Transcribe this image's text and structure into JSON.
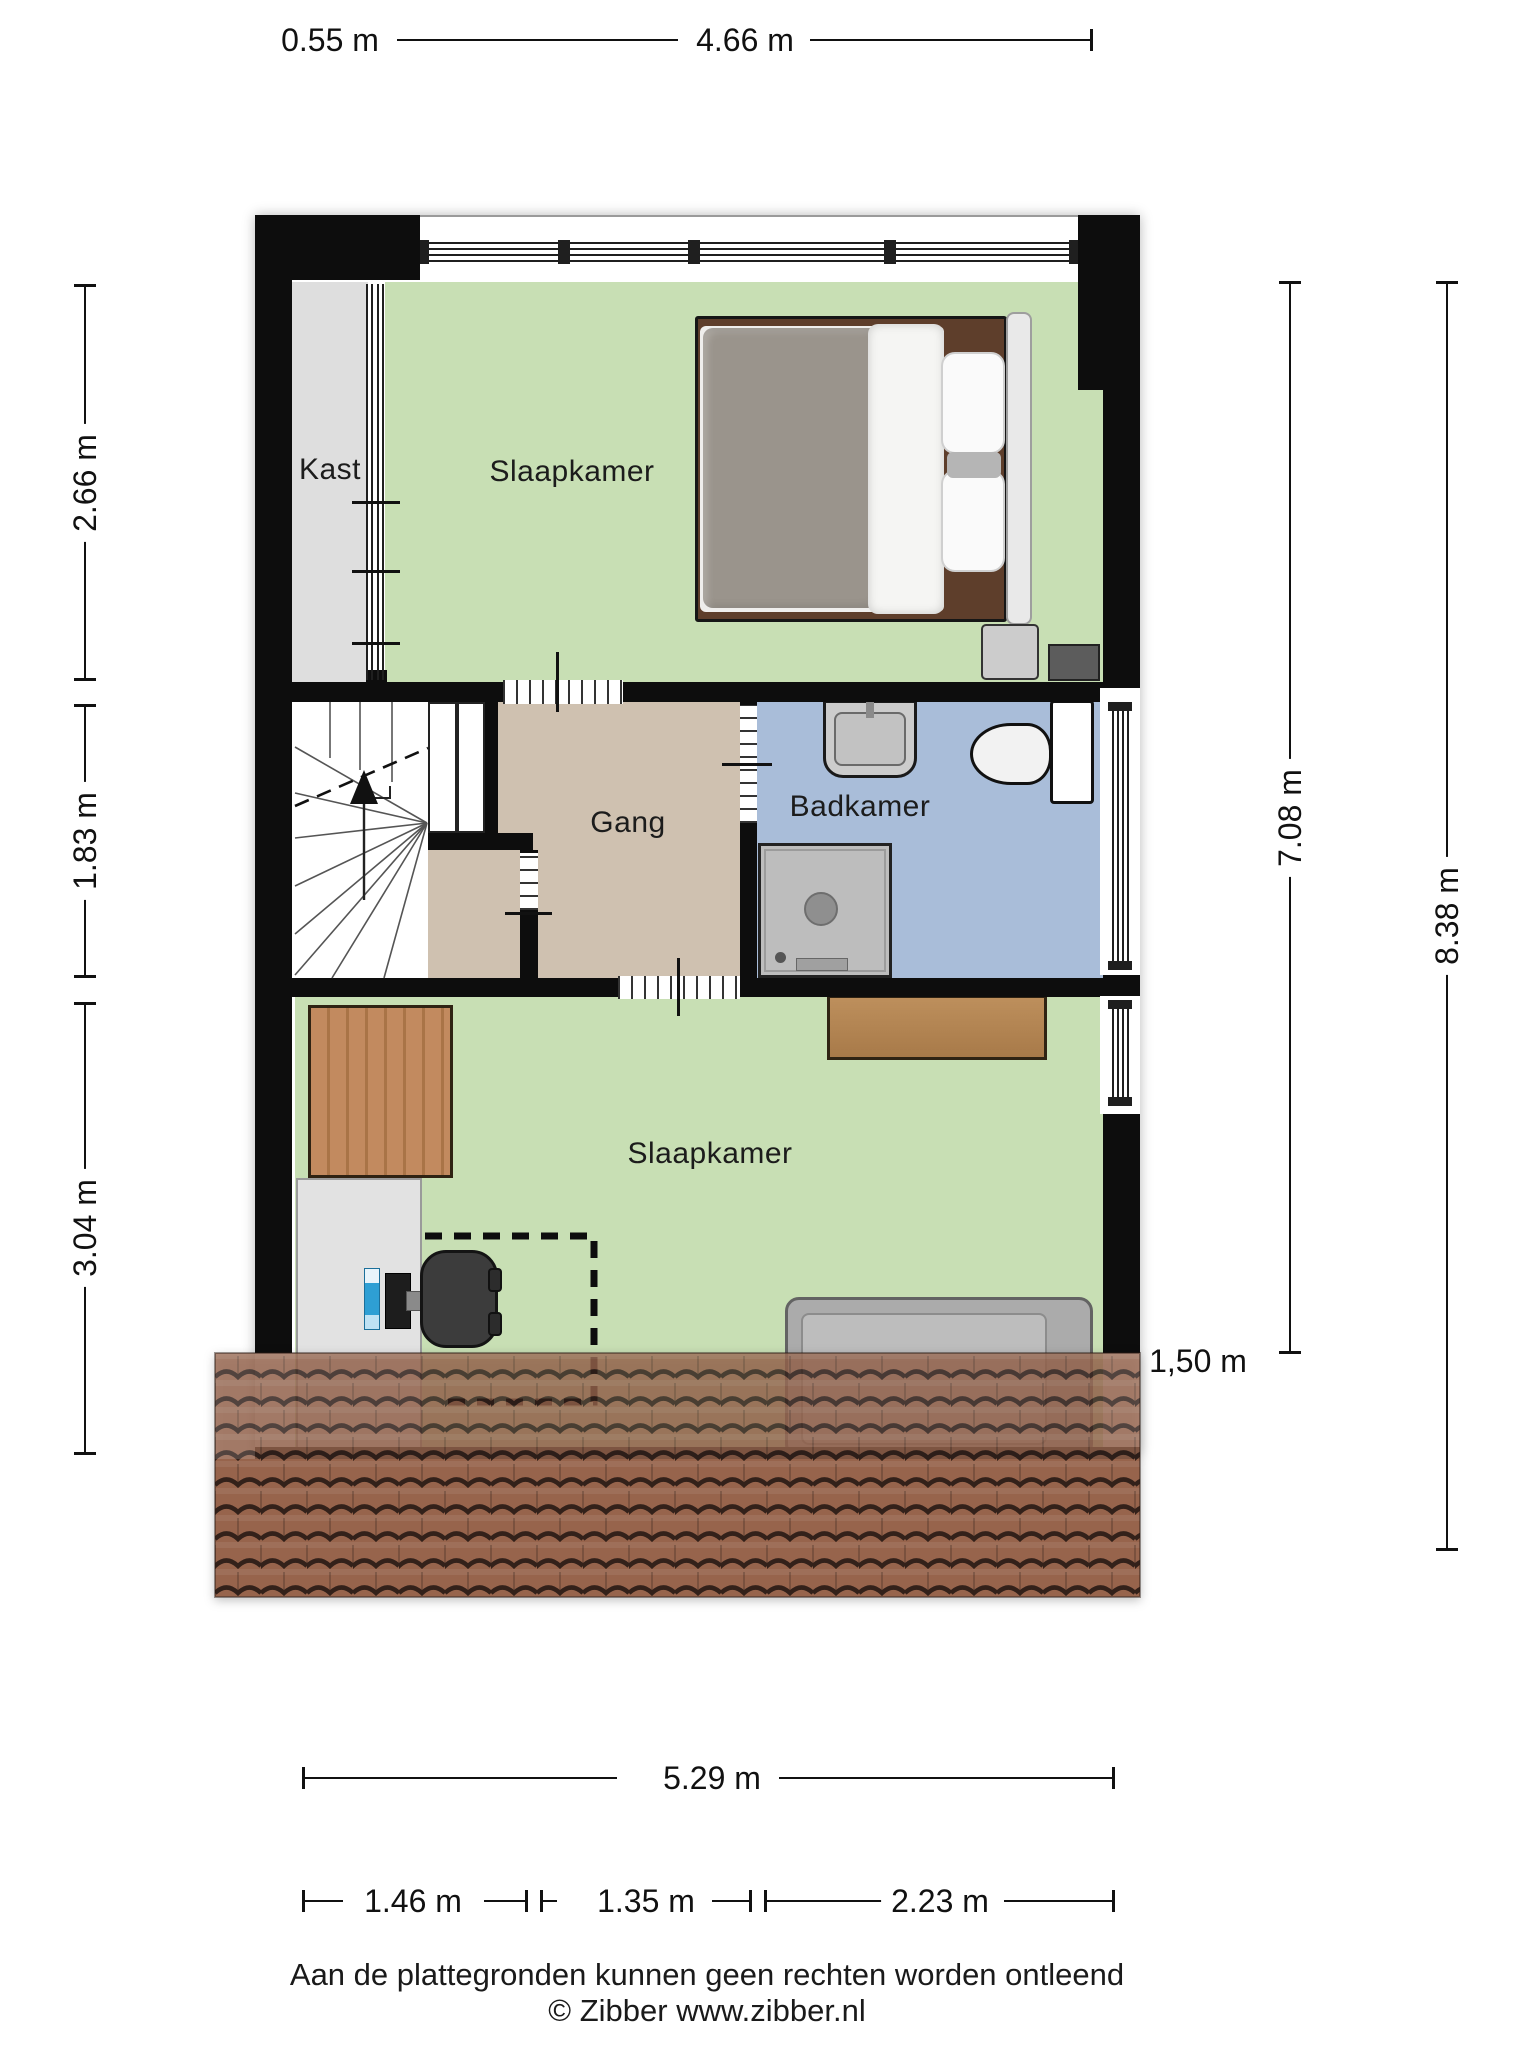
{
  "rooms": {
    "closet": {
      "label": "Kast"
    },
    "bedroom_top": {
      "label": "Slaapkamer"
    },
    "hallway": {
      "label": "Gang"
    },
    "bathroom": {
      "label": "Badkamer"
    },
    "bedroom_bottom": {
      "label": "Slaapkamer"
    }
  },
  "dimensions": {
    "top": [
      {
        "label": "0.55 m"
      },
      {
        "label": "4.66 m"
      }
    ],
    "left": [
      {
        "label": "2.66 m"
      },
      {
        "label": "1.83 m"
      },
      {
        "label": "3.04 m"
      }
    ],
    "right": [
      {
        "label": "7.08 m"
      },
      {
        "label": "8.38 m"
      }
    ],
    "roof_height": {
      "label": "1,50 m"
    },
    "bottom_total": {
      "label": "5.29 m"
    },
    "bottom_segments": [
      {
        "label": "1.46 m"
      },
      {
        "label": "1.35 m"
      },
      {
        "label": "2.23 m"
      }
    ]
  },
  "footer": {
    "disclaimer": "Aan de plattegronden kunnen geen rechten worden ontleend",
    "copyright": "© Zibber www.zibber.nl"
  },
  "colors": {
    "bedroom_fill": "#c8dfb4",
    "hallway_fill": "#cfc1b0",
    "bathroom_fill": "#a9bdd9",
    "closet_fill": "#dedede",
    "roof_fill": "#97644c",
    "wall": "#0d0d0d"
  }
}
